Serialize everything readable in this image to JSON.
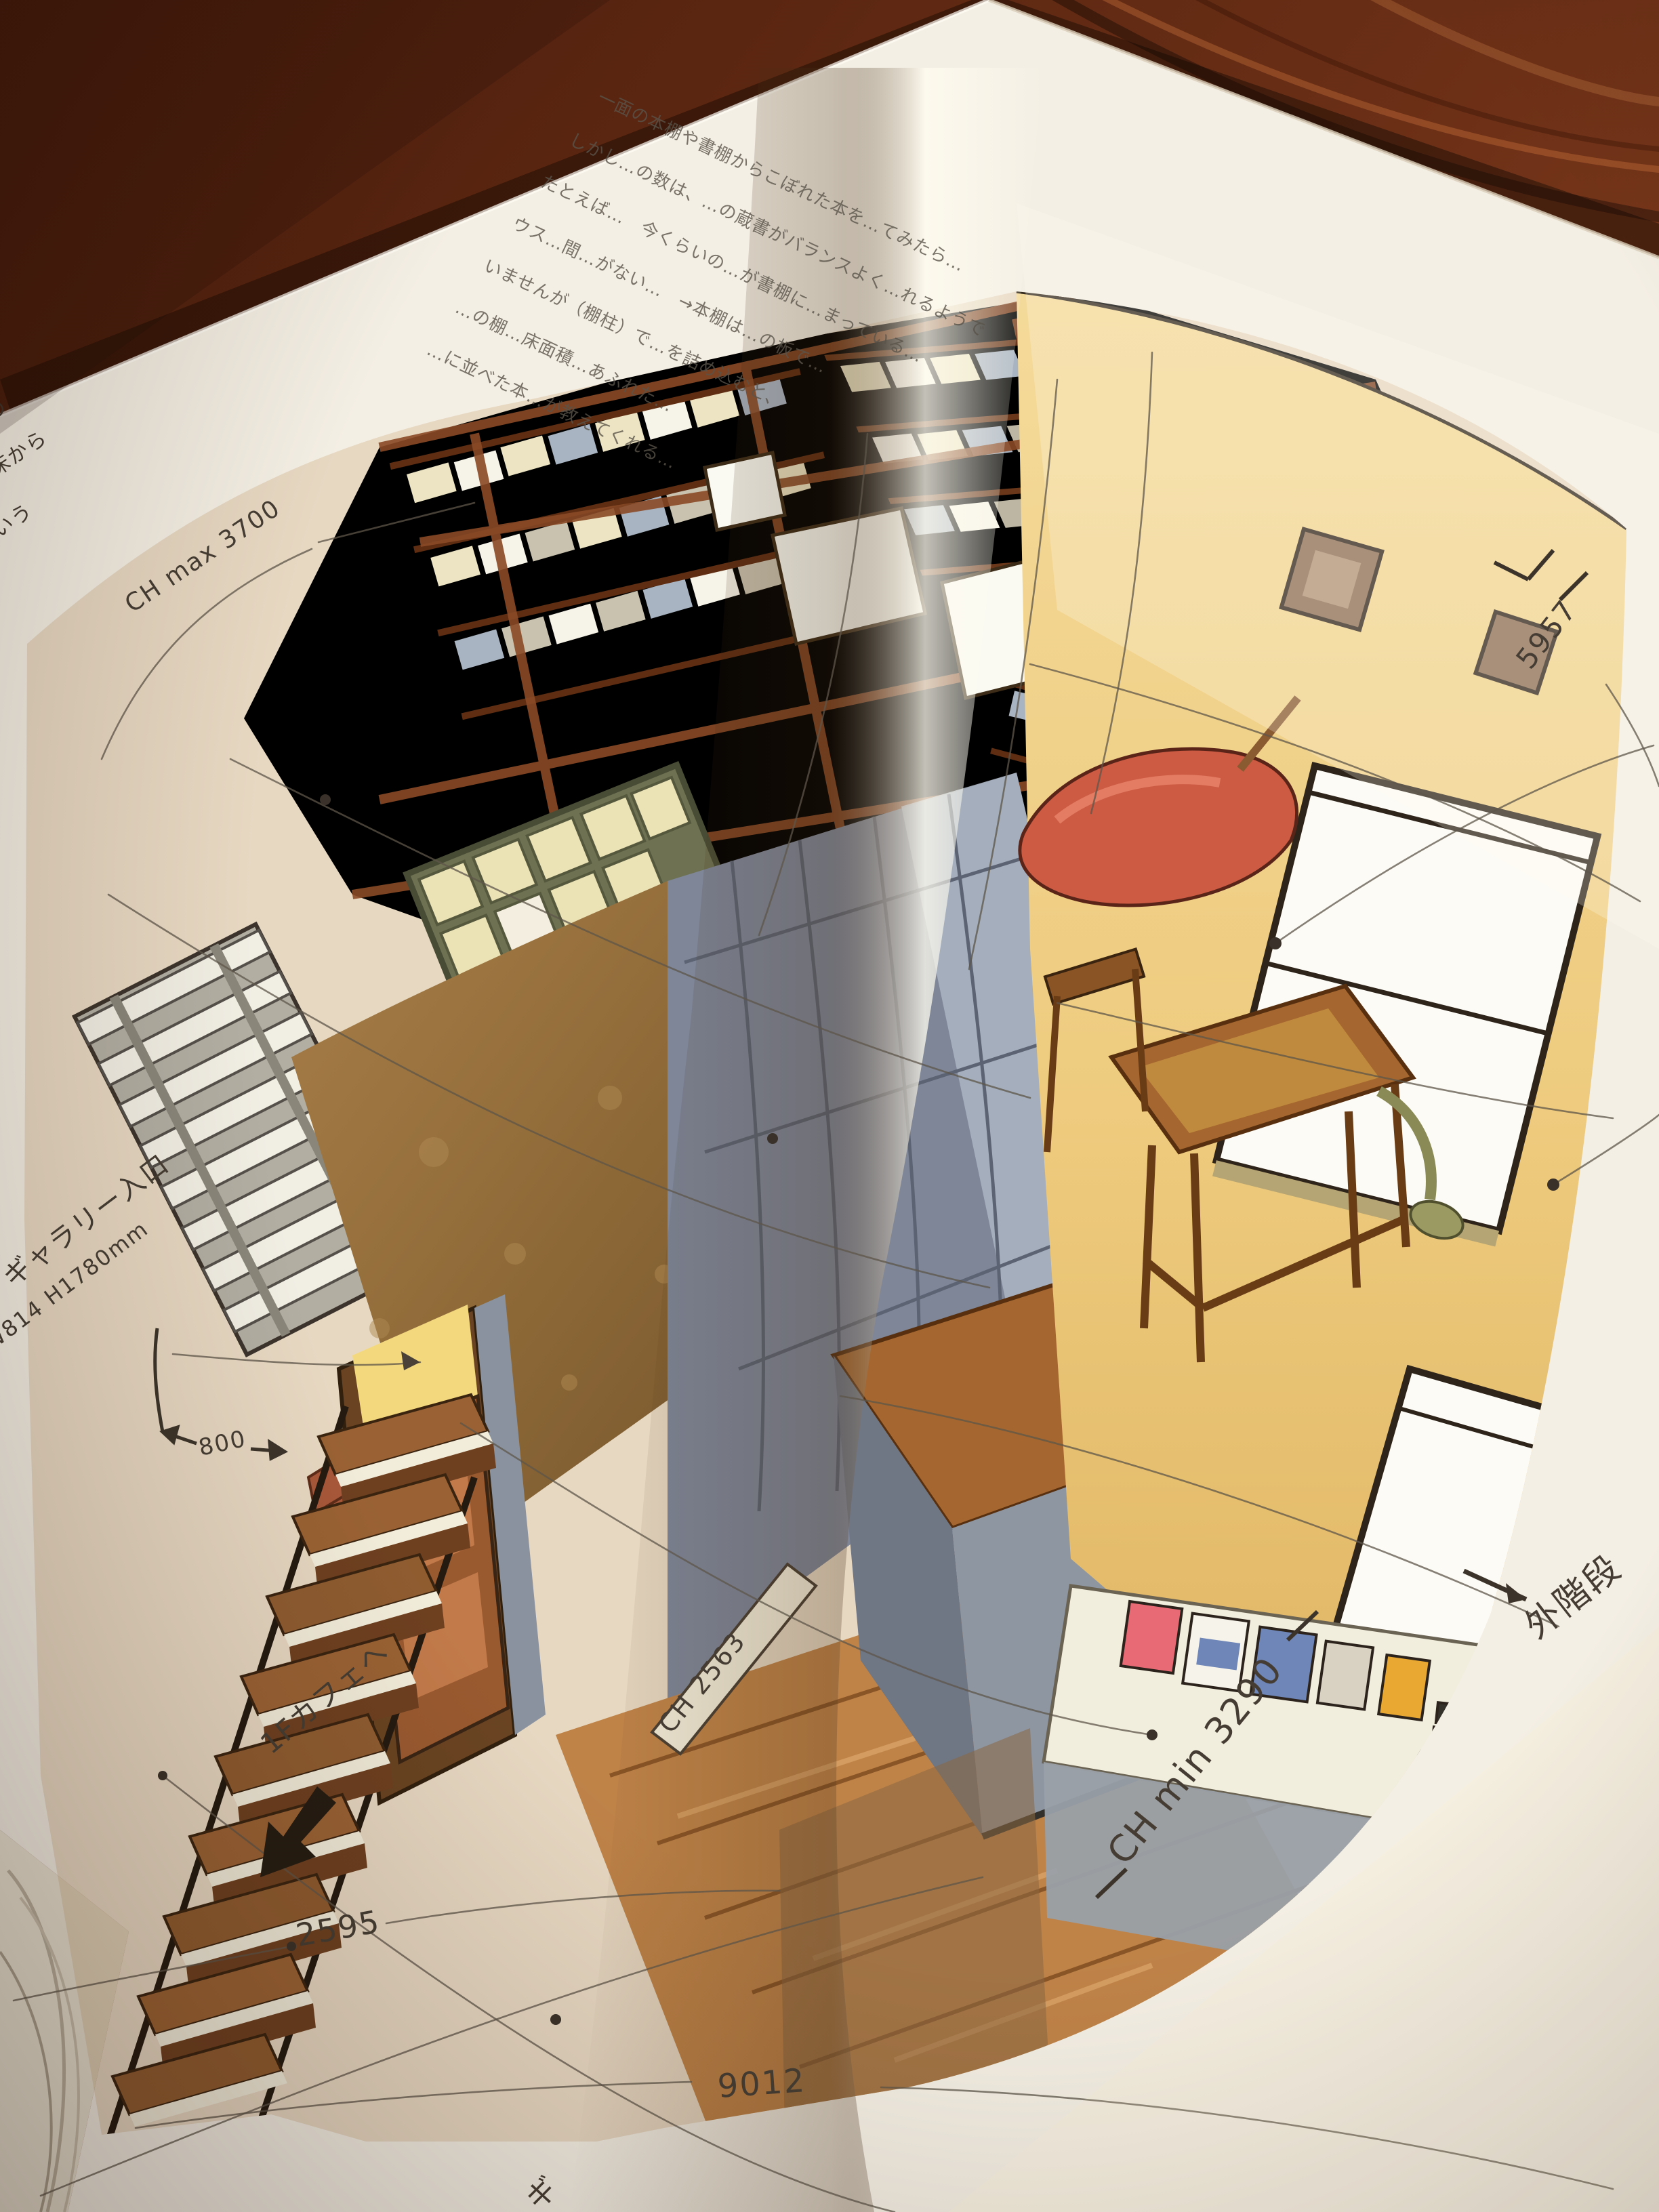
{
  "photo_subject": "open book on wood table showing watercolor interior sketch of a bookshop with handwritten notes",
  "palette": {
    "paper": "#f4efe4",
    "paper_bright": "#fbf9f2",
    "wood": "#6b2f16",
    "wood_light": "#a85a2a",
    "ink": "#453d33",
    "pencil": "#5e554a",
    "shelf_wood": "#8a4a26",
    "shelf_dark": "#6130166",
    "book_cream": "#ece4c2",
    "book_white": "#f6f3e8",
    "book_blue": "#a9b4c2",
    "slate": "#7e8698",
    "slate_light": "#a9b3c0",
    "slate_dark": "#5c6474",
    "gold_wall": "#977040",
    "yellow_wall": "#eecb7e",
    "glow": "#eac35c",
    "green_shelf": "#6e7252",
    "floor": "#bf8348",
    "red_seat": "#cd5b44",
    "table_wood": "#a5672f",
    "window_white": "#fcfbf5",
    "counter_gray": "#8e96a2",
    "display_white": "#f2eedd",
    "item_pink": "#e86a74",
    "item_blue": "#6e86b8",
    "item_yellow": "#e8a832"
  },
  "book": {
    "paragraph_lines": [
      "一面の本棚や書棚からこぼれた本を…てみたら…",
      "しかし…の数は、…の蔵書がバランスよく…れるようで",
      "たとえば…　今くらいの…が書棚に…まっている…",
      "ウス…間…がない…　→本棚は…の板で…",
      "いませんが（棚柱）で…を詰め込むと、",
      "…の棚…床面積…あふれた…",
      "…に並べた本…が教えてくれる…"
    ],
    "margin_notes_left": [
      "…の",
      "…は床から",
      "…ろいう"
    ],
    "labels": {
      "ch_max": "CH max 3700",
      "dim_5957": "5957",
      "gallery_line1": "ギャラリー入口",
      "gallery_line2": "W814 H1780mm",
      "dim_800": "800",
      "ch_counter": "CH 2563",
      "ch_min": "CH min 3290",
      "outside_stairs": "外階段",
      "cafe": "1Fカフェへ",
      "dim_2595": "2595",
      "dim_9012": "9012",
      "bottom_partial": "ギ"
    }
  }
}
